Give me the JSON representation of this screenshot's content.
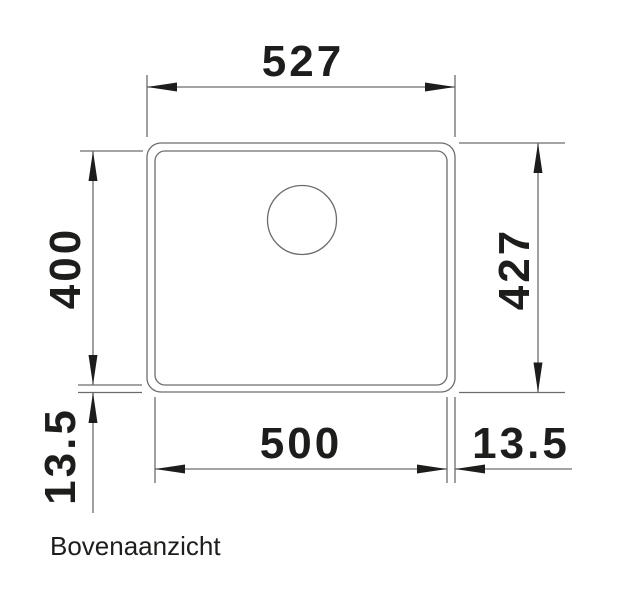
{
  "drawing": {
    "caption": "Bovenaanzicht",
    "dimensions": {
      "outer_width": "527",
      "bowl_height": "400",
      "outer_height": "427",
      "bowl_width": "500",
      "bottom_offset": "13.5",
      "right_offset": "13.5"
    },
    "colors": {
      "line": "#6b6c6f",
      "ink": "#1d1d1b",
      "background": "#ffffff"
    }
  }
}
